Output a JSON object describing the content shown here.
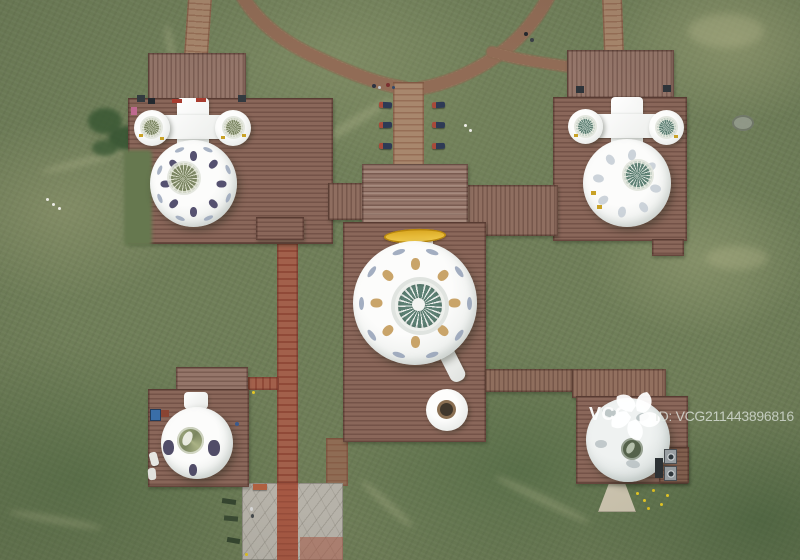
{
  "scene": {
    "type": "aerial-drone-photo",
    "subject": "White yurt-dome buildings on brown wooden platforms connected by boardwalks in green grassland, viewed from directly above"
  },
  "watermark": {
    "logo_text": "VCG",
    "id_text": "ID: VCG211443896816",
    "logo_icon": "vcg-pinwheel-logo"
  },
  "colors": {
    "grass_base": "#71805a",
    "deck": "#8a675a",
    "deck_light": "#95766a",
    "path_brick": "#a8876d",
    "path_red": "#a2604b",
    "plaza": "#b6b2a9",
    "plaza_red": "#a55843",
    "dome_white": "#f0f2f0",
    "skylight_teal": "#5d8074",
    "cupola_olive": "#7c8663",
    "motif_navy": "#555170",
    "motif_tan": "#c9a469",
    "motif_feather": "#93a0b6",
    "crescent_gold": "#e7b92d"
  }
}
